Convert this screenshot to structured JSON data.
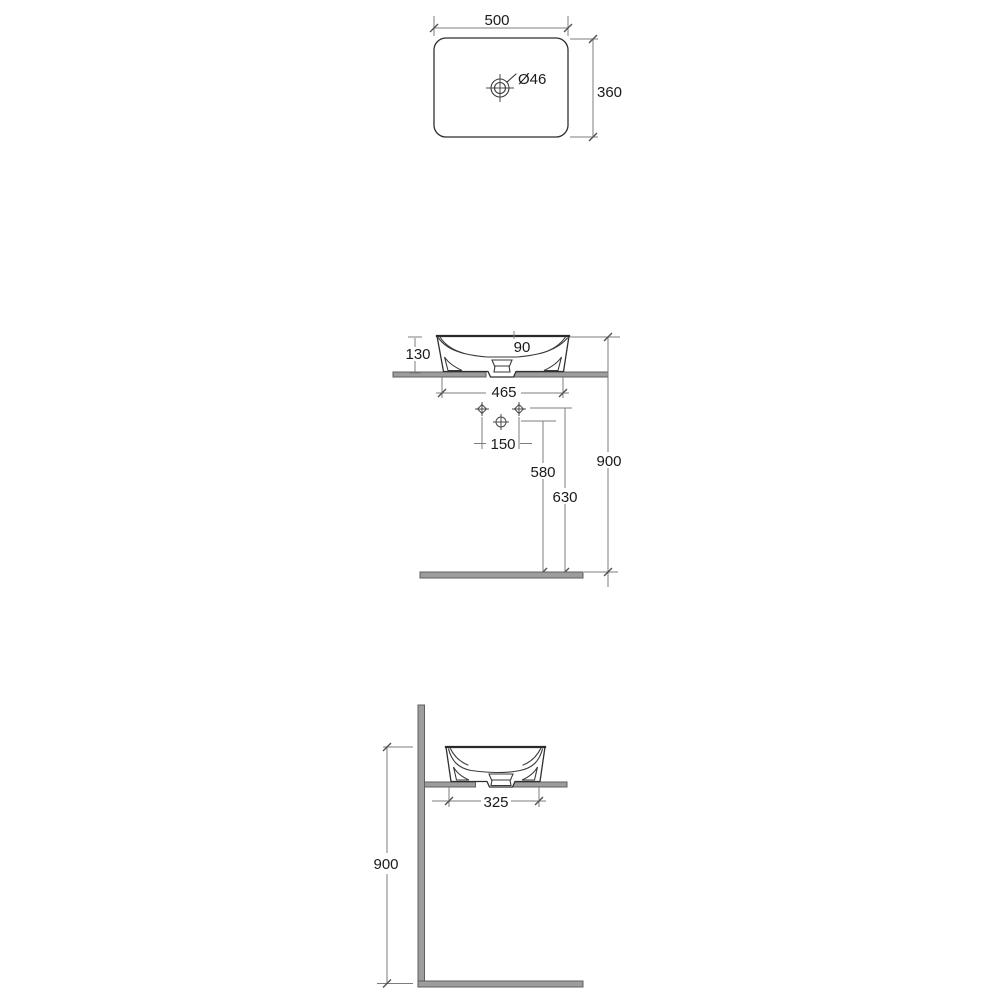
{
  "meta": {
    "background_color": "#ffffff",
    "object_line_color": "#2f2f2f",
    "dimension_line_color": "#7d7d7d",
    "text_color": "#1a1a1a",
    "surface_fill_color": "#9d9d9d",
    "surface_stroke_color": "#5e5e5e"
  },
  "views": {
    "top_view": {
      "width_label": "500",
      "depth_label": "360",
      "tap_hole_label": "Ø46"
    },
    "front_view": {
      "height_label": "130",
      "inner_depth_label": "90",
      "base_width_label": "465",
      "tap_spacing_label": "150",
      "drain_height_label": "580",
      "supply_height_label": "630",
      "rim_height_label": "900"
    },
    "side_view": {
      "base_depth_label": "325",
      "rim_height_label": "900"
    }
  }
}
